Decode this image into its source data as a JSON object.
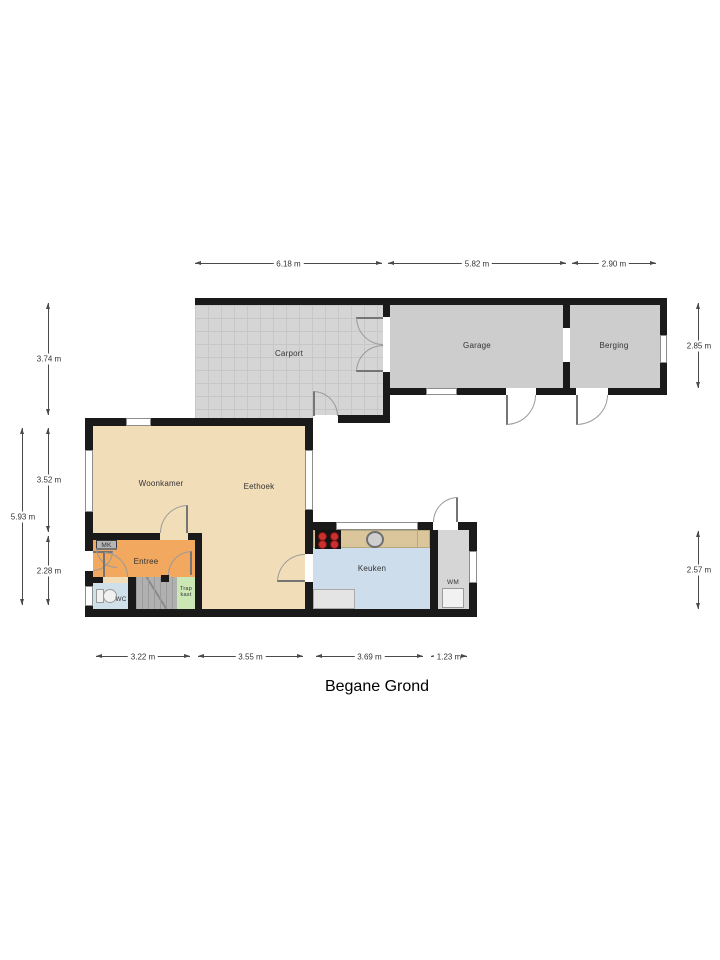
{
  "title": "Begane Grond",
  "rooms": {
    "carport": "Carport",
    "garage": "Garage",
    "berging": "Berging",
    "woonkamer": "Woonkamer",
    "eethoek": "Eethoek",
    "entree": "Entree",
    "mk": "MK",
    "wc": "WC",
    "trapkast": "Trap\nkast",
    "keuken": "Keuken",
    "wm": "WM"
  },
  "dimensions": {
    "top": [
      "6.18 m",
      "5.82 m",
      "2.90 m"
    ],
    "left": [
      "3.74 m",
      "3.52 m",
      "2.28 m",
      "5.93 m"
    ],
    "right": [
      "2.85 m",
      "2.57 m"
    ],
    "bottom": [
      "3.22 m",
      "3.55 m",
      "3.69 m",
      "1.23 m"
    ]
  },
  "colors": {
    "wall": "#1a1a1a",
    "carport_floor": "#d5d5d5",
    "garage_floor": "#cdcdcd",
    "living_floor": "#f2ddb9",
    "entree_floor": "#f2a85e",
    "wc_floor": "#cfe0ea",
    "stairs": "#b0b0b0",
    "trapkast_floor": "#cbe7b4",
    "kitchen_floor": "#cdddec",
    "counter": "#dbc69c",
    "wm_floor": "#d6d6d6",
    "cooktop": "#141414",
    "burner": "#c93030",
    "dimension_text": "#333333"
  }
}
